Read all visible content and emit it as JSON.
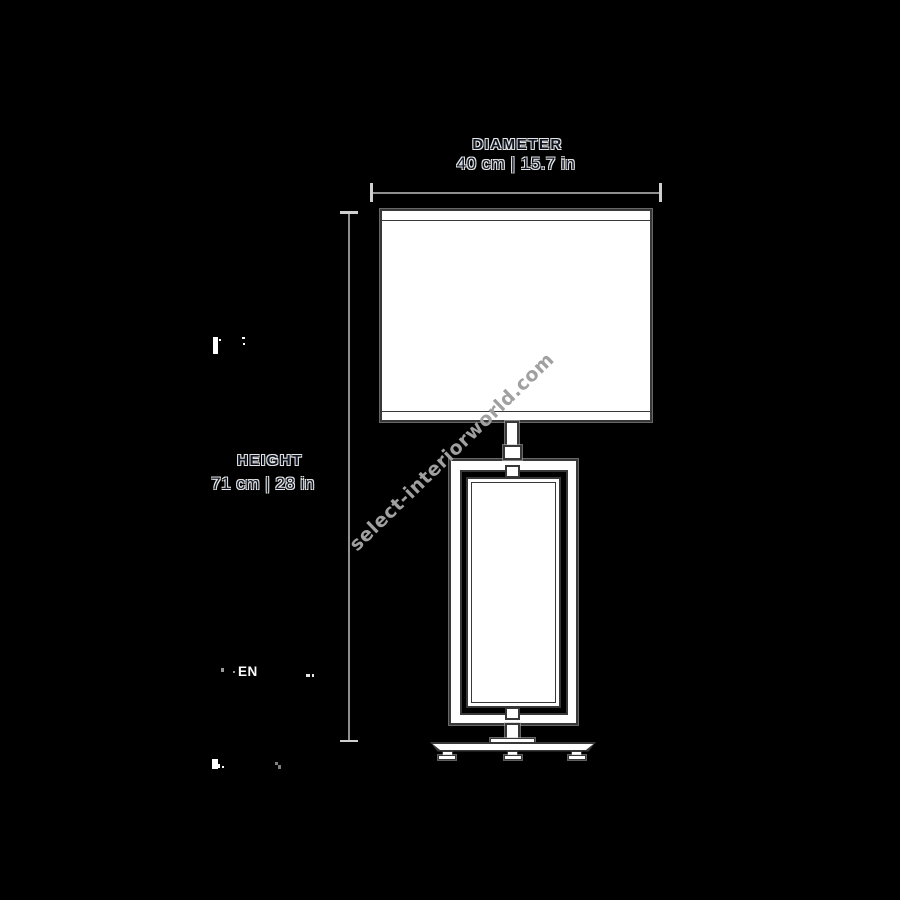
{
  "diagram": {
    "type": "product-dimension-drawing",
    "subject": "table lamp with drum shade, rectangular open-frame body and three-footed base"
  },
  "dimensions": {
    "diameter": {
      "label": "DIAMETER",
      "value": "40 cm | 15.7 in"
    },
    "height": {
      "label": "HEIGHT",
      "value": "71 cm | 28 in"
    }
  },
  "watermark": {
    "text": "select-interiorworld.com",
    "rotation_deg": -44
  },
  "artifacts": {
    "language_code": "EN"
  },
  "colors": {
    "background": "#000000",
    "line-gray": "#8f8f8f",
    "tick-light": "#cfcfcf",
    "outline-dark": "#383838",
    "fill-white": "#ffffff",
    "watermark-gray": "#a0a0a0",
    "text-fill": "#0d1522",
    "text-outline": "#e4e4e4",
    "artifact-white": "#ffffff"
  }
}
